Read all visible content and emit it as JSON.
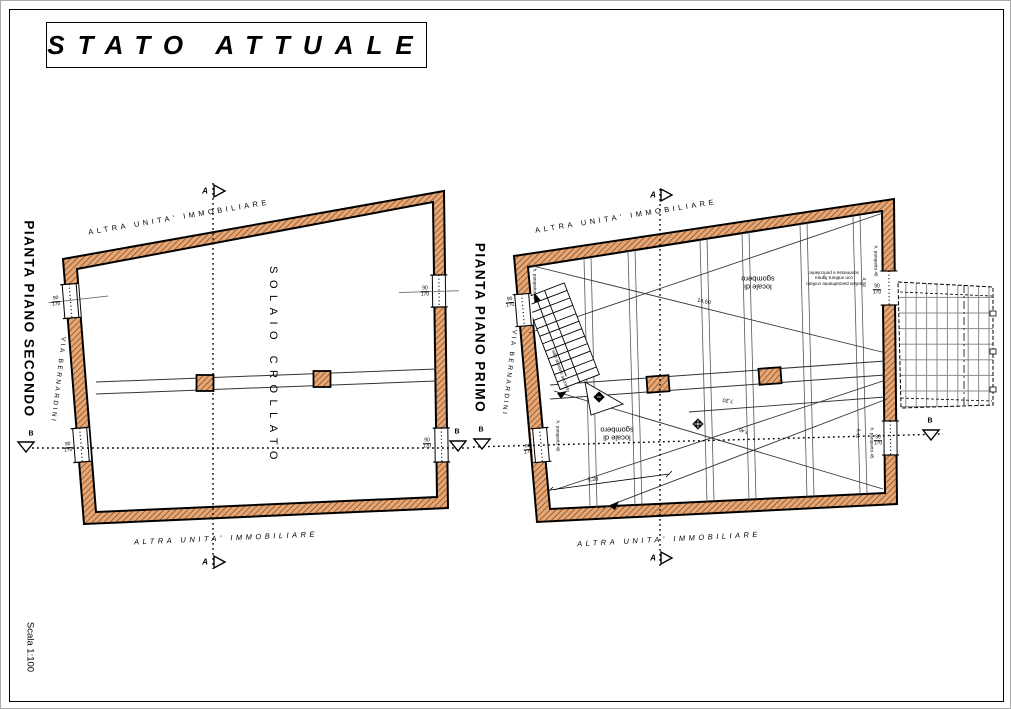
{
  "title": "STATO ATTUALE",
  "scale_label": "Scala 1:100",
  "colors": {
    "wall_fill": "#e2a878",
    "wall_hatch": "#9c5020",
    "line": "#000000"
  },
  "markers": {
    "a": "A",
    "b": "B"
  },
  "left_plan": {
    "name": "PIANTA PIANO SECONDO",
    "top_boundary": "ALTRA UNITA' IMMOBILIARE",
    "bottom_boundary": "ALTRA UNITA' IMMOBILIARE",
    "street": "VIA BERNARDINI",
    "room": "SOLAIO CROLLATO",
    "window_tag_w": "90",
    "window_tag_h": "170"
  },
  "right_plan": {
    "name": "PIANTA PIANO PRIMO",
    "top_boundary": "ALTRA UNITA' IMMOBILIARE",
    "bottom_boundary": "ALTRA UNITA' IMMOBILIARE",
    "street": "VIA BERNARDINI",
    "room_upper": "locale di sgombero",
    "room_lower": "locale di sgombero",
    "stair_label": "sale al piano secondo",
    "note": "solaio parzialmente crollato con orditura lignea sconnessa e pericolante",
    "parapet": "h. parapetto 45",
    "window_tag_w": "90",
    "window_tag_h": "170",
    "dims": {
      "d1": "14,50",
      "d2": "7,20",
      "d3": "7,46",
      "d4": "3,43",
      "d5": "5,28",
      "d6": "4,38"
    }
  }
}
